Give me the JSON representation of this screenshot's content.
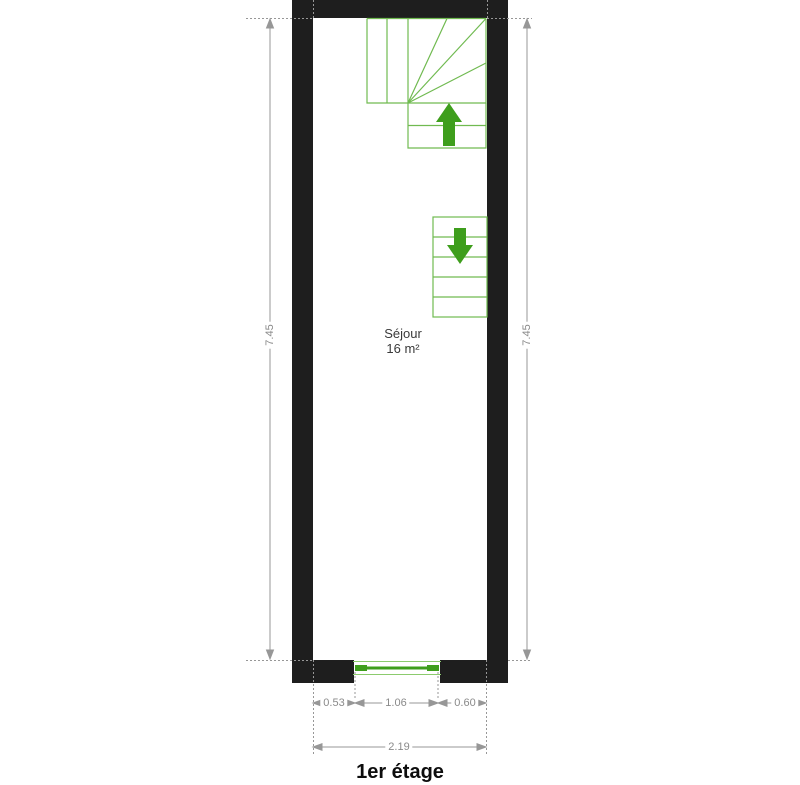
{
  "plan": {
    "title": "1er étage",
    "room": {
      "name": "Séjour",
      "area": "16 m²"
    },
    "dimensions": {
      "left_height_m": "7.45",
      "right_height_m": "7.45",
      "bottom_left_m": "0.53",
      "bottom_window_m": "1.06",
      "bottom_right_m": "0.60",
      "bottom_total_m": "2.19"
    },
    "icons": {
      "up_arrow": "stair-direction-up",
      "down_arrow": "stair-direction-down"
    },
    "colors": {
      "wall": "#1e1e1e",
      "stair_line": "#70ba50",
      "window_thin_line": "#8ccb6e",
      "arrow_green": "#3e9e1c",
      "dimension_gray": "#979797",
      "dimension_text": "#8a8a8a",
      "label_dark": "#3a3a3a",
      "background": "#ffffff"
    }
  }
}
